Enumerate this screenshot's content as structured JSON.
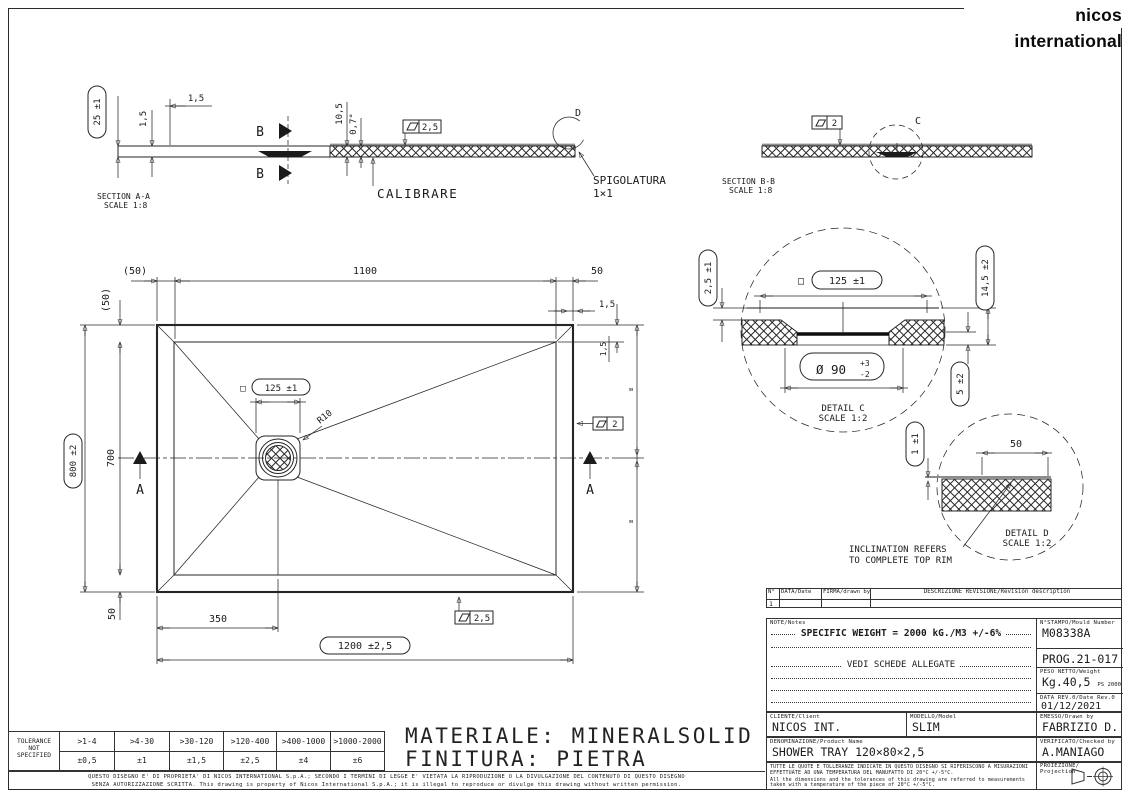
{
  "logo": {
    "brand": "nicos international"
  },
  "section_aa": {
    "title": "SECTION A-A",
    "scale": "SCALE 1:8",
    "dim_height": "25 ±1",
    "dim_edge_top": "1,5",
    "dim_edge_left": "1,5",
    "cut_label": "B",
    "dim_10_5": "10,5",
    "dim_angle": "0,7°",
    "flatness": "2,5",
    "calibrare": "CALIBRARE",
    "detail_ref": "D",
    "spig1": "SPIGOLATURA",
    "spig2": "1×1"
  },
  "section_bb": {
    "title": "SECTION B-B",
    "scale": "SCALE 1:8",
    "flatness": "2",
    "detail_ref": "C"
  },
  "plan": {
    "dim_50_paren_h": "(50)",
    "dim_1100": "1100",
    "dim_50_tr": "50",
    "dim_1_5_tr": "1,5",
    "dim_50_paren_v": "(50)",
    "dim_800": "800 ±2",
    "dim_700": "700",
    "square": "□",
    "dim_125": "125 ±1",
    "r10": "R10",
    "cut_label": "A",
    "flatness_right": "2",
    "equal_mark": "\"",
    "dim_1_5_right": "1,5",
    "dim_50_bl": "50",
    "dim_350": "350",
    "flatness_bottom": "2,5",
    "dim_1200": "1200 ±2,5"
  },
  "detail_c": {
    "title": "DETAIL C",
    "scale": "SCALE 1:2",
    "dim_depth": "2,5 ±1",
    "square": "□",
    "dim_125": "125 ±1",
    "dim_height": "14,5 ±2",
    "dim_hole": "Ø 90",
    "tol_plus": "+3",
    "tol_minus": "-2",
    "dim_flange": "5 ±2"
  },
  "detail_d": {
    "title": "DETAIL D",
    "scale": "SCALE 1:2",
    "dim_lip": "1 ±1",
    "dim_rim": "50",
    "note1": "INCLINATION REFERS",
    "note2": "TO COMPLETE TOP RIM"
  },
  "material": {
    "line1": "MATERIALE: MINERALSOLID",
    "line2": "FINITURA: PIETRA"
  },
  "revision_table": {
    "col_no": "N°",
    "col_date": "DATA/Date",
    "col_sign": "FIRMA/drawn by",
    "col_desc": "DESCRIZIONE REVISIONE/Revision description",
    "rows": [
      {
        "no": "1"
      }
    ]
  },
  "title_block": {
    "note_label": "NOTE/Notes",
    "note_1": "SPECIFIC WEIGHT = 2000 kG./M3 +/-6%",
    "note_2": "VEDI SCHEDE ALLEGATE",
    "mould_label": "N°STAMPO/Mould Number",
    "mould_value": "M08338A",
    "prog_value": "PROG.21-017",
    "weight_label": "PESO NETTO/Weight",
    "weight_value": "Kg.40,5",
    "weight_sub": "PS 2000",
    "daterev_label": "DATA REV.0/Date Rev.0",
    "daterev_value": "01/12/2021",
    "client_label": "CLIENTE/Client",
    "client_value": "NICOS INT.",
    "model_label": "MODELLO/Model",
    "model_value": "SLIM",
    "drawnby_label": "EMESSO/Drawn by",
    "drawnby_value": "FABRIZIO D.",
    "product_label": "DENOMINAZIONE/Product Name",
    "product_value": "SHOWER TRAY 120×80×2,5",
    "checkedby_label": "VERIFICATO/Checked by",
    "checkedby_value": "A.MANIAGO",
    "temp_note_it": "TUTTE LE QUOTE E TOLLERANZE INDICATE IN QUESTO DISEGNO SI RIFERISCONO A MISURAZIONI EFFETTUATE AD UNA TEMPERATURA DEL MANUFATTO DI 20°C +/-5°C.",
    "temp_note_en": "All the dimensions and the tolerances of this drawing are referred to measurements taken with a temperature of the piece of 20°C +/-5°C.",
    "projection_label": "PROIEZIONE/",
    "projection_label2": "Projection"
  },
  "tolerance_table": {
    "label_lines": [
      "TOLERANCE",
      "NOT",
      "SPECIFIED"
    ],
    "ranges": [
      ">1-4",
      ">4-30",
      ">30-120",
      ">120-400",
      ">400-1000",
      ">1000-2000"
    ],
    "values": [
      "±0,5",
      "±1",
      "±1,5",
      "±2,5",
      "±4",
      "±6"
    ]
  },
  "disclaimer": {
    "line1": "QUESTO DISEGNO E' DI PROPRIETA' DI NICOS INTERNATIONAL S.p.A.; SECONDO I TERMINI DI LEGGE E' VIETATA LA RIPRODUZIONE O LA DIVULGAZIONE DEL CONTENUTO DI QUESTO DISEGNO",
    "line2": "SENZA AUTORIZZAZIONE SCRITTA. This drawing is property of Nicos International S.p.A.; it is illegal to reproduce or divulge this drawing without written permission."
  }
}
